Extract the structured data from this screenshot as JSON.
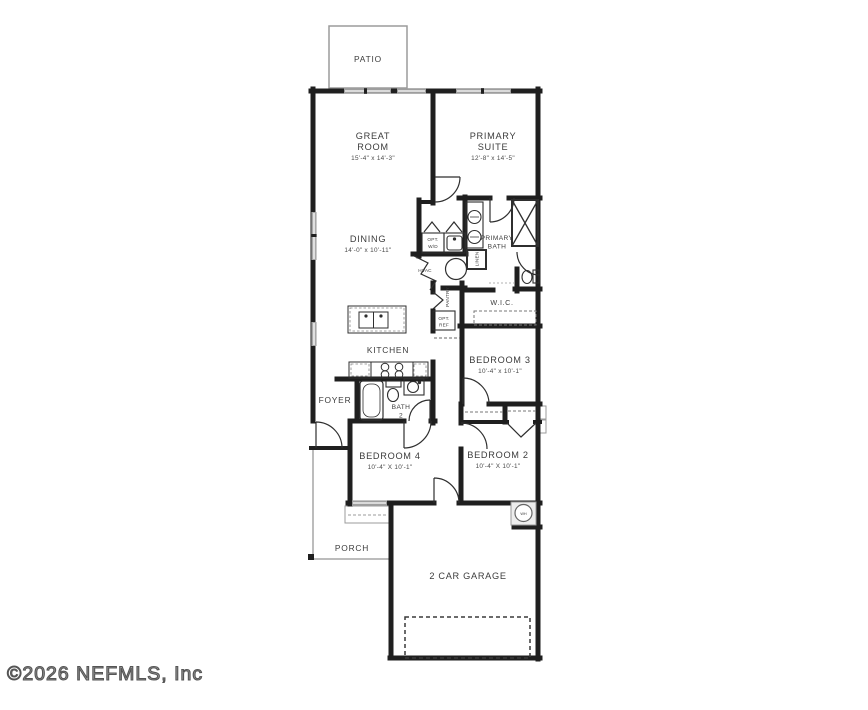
{
  "colors": {
    "wall": "#1f1f1f",
    "window": "#9e9e9e",
    "thin": "#9b9b9b",
    "text": "#3c3c3c"
  },
  "footer": {
    "copyright": "©2026 NEFMLS, Inc"
  },
  "plan": {
    "patio": {
      "label": "PATIO"
    },
    "great_room": {
      "line1": "GREAT",
      "line2": "ROOM",
      "dims": "15'-4\" x 14'-3\""
    },
    "primary_suite": {
      "line1": "PRIMARY",
      "line2": "SUITE",
      "dims": "12'-8\" x 14'-5\""
    },
    "dining": {
      "label": "DINING",
      "dims": "14'-0\" x 10'-11\""
    },
    "laundry": {
      "line1": "OPT.",
      "line2": "W/D"
    },
    "primary_bath": {
      "line1": "PRIMARY",
      "line2": "BATH"
    },
    "linen": {
      "label": "LINEN"
    },
    "hvac": {
      "label": "HVAC"
    },
    "pantry": {
      "label": "PANTRY"
    },
    "opt_ref": {
      "line1": "OPT.",
      "line2": "REF"
    },
    "wic": {
      "label": "W.I.C."
    },
    "kitchen": {
      "label": "KITCHEN"
    },
    "bedroom3": {
      "label": "BEDROOM 3",
      "dims": "10'-4\" x 10'-1\""
    },
    "foyer": {
      "label": "FOYER"
    },
    "bath2": {
      "line1": "BATH",
      "line2": "2"
    },
    "bedroom4": {
      "label": "BEDROOM 4",
      "dims": "10'-4\" X 10'-1\""
    },
    "bedroom2": {
      "label": "BEDROOM 2",
      "dims": "10'-4\" X 10'-1\""
    },
    "porch": {
      "label": "PORCH"
    },
    "garage": {
      "label": "2 CAR GARAGE"
    },
    "water_heater": {
      "label": "WH"
    }
  }
}
